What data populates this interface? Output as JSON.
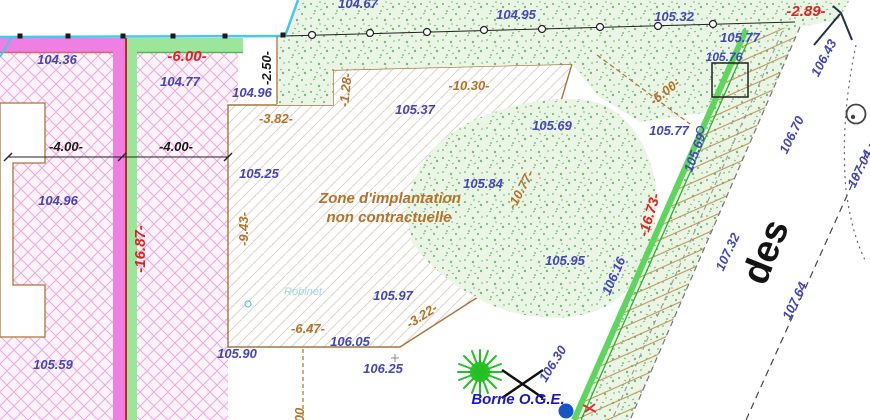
{
  "plan": {
    "zone_label_line1": "Zone d'implantation",
    "zone_label_line2": "non contractuelle",
    "street_name_fragment": "des",
    "borne_label": "Borne O.G.E.",
    "tap_label": "Robinet",
    "elevations": [
      "104.36",
      "104.67",
      "104.95",
      "105.32",
      "105.77",
      "105.76",
      "104.77",
      "104.96",
      "105.37",
      "105.69",
      "105.77",
      "104.96",
      "105.25",
      "105.84",
      "105.95",
      "105.97",
      "106.05",
      "105.90",
      "106.25",
      "105.59"
    ],
    "elevations_rotated": [
      "106.43",
      "105.69",
      "106.70",
      "106.16",
      "107.32",
      "107.64",
      "107.04",
      "106.30"
    ],
    "dimensions_red": [
      "-6.00-",
      "-2.89-",
      "-16.87-",
      "-16.73-"
    ],
    "dimensions_black": [
      "-4.00-",
      "-4.00-",
      "-2.50-"
    ],
    "dimensions_brown": [
      "-10.30-",
      "-1.28-",
      "-3.82-",
      "-5.00-",
      "-9.43-",
      "-10.77-",
      "-6.47-",
      "-3.22-",
      "00"
    ],
    "colors": {
      "elevation_blue": "#4444bb",
      "dimension_red": "#e31f1f",
      "dimension_brown": "#b5722a",
      "parcel_magenta": "#ef7fe3",
      "band_green": "#9ce69c",
      "talus_green": "#5cd65c",
      "borne_blue": "#1818c8",
      "crosshatch_pink": "#e9aadc",
      "stipple_green_bg": "#eaf5e6"
    },
    "icons": {
      "tree": "tree-icon",
      "boundary_cross": "boundary-cross-icon",
      "survey_point": "survey-point-dot",
      "utility_circle": "utility-circle-icon",
      "flow_arrow": "flow-arrow-icon",
      "fence_post": "fence-post-icon",
      "tap_marker": "tap-marker-icon"
    }
  }
}
